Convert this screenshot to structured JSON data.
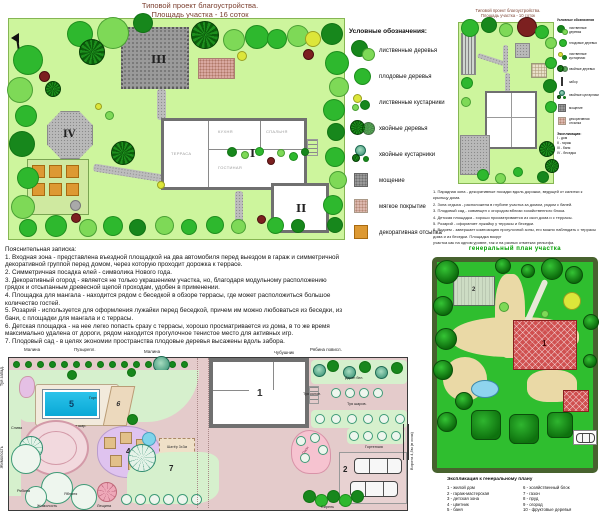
{
  "top_left": {
    "title1": "Типовой проект благоустройства.",
    "title2": "Площадь участка - 16 соток",
    "num_house": "I",
    "num_garage": "II",
    "num_paving": "III",
    "num_gazebo": "IV",
    "room_terrace": "ТЕРРАСА",
    "room_living": "ГОСТИНАЯ",
    "room_kitchen": "КУХНЯ",
    "room_bedroom": "СПАЛЬНЯ"
  },
  "legend": {
    "title": "Условные обозначения:",
    "items": [
      "лиственные деревья",
      "плодовые деревья",
      "лиственные кустарники",
      "хвойные деревья",
      "хвойные кустарники",
      "мощение",
      "мягкое покрытие",
      "декоративная отсыпка"
    ]
  },
  "top_right": {
    "title1": "Типовой проект благоустройства.",
    "title2": "Площадь участка - 10 соток",
    "legend_title": "Условные обозначения",
    "legend_items": [
      "лиственные деревья",
      "плодовые деревья",
      "лиственные кустарники",
      "хвойные деревья",
      "забор",
      "хвойные кустарники",
      "мощение",
      "декоративная отсыпка"
    ],
    "explication_title": "Экспликация:",
    "explication": [
      "I - дом",
      "II - гараж",
      "III - баня",
      "IV - беседка"
    ],
    "notes": [
      "1. Парадная зона - декоративные посадки вдоль дорожки, ведущей от калитки к крыльцу дома.",
      "2. Зона отдыха - расположена в глубине участка за домом, рядом с баней.",
      "3. Плодовый сад - совмещен с огородом вблизи хозяйственного блока.",
      "4. Детская площадка - хорошо просматривается из окон дома и с террасы.",
      "5. Розарий - оформляет лужайку у террасы и беседки."
    ]
  },
  "notes": {
    "title": "Пояснительная записка:",
    "items": [
      "1. Входная зона - представлена въездной площадкой на два автомобиля перед выездом в гараж и симметричной декоративной группой перед домом, через которую проходит дорожка к террасе.",
      "2. Симметричная посадка елей - символика Нового года.",
      "3. Декоративный огород - является не только украшением участка, но, благодаря модульному расположению грядок и отсыпанным древесной щепой проходам, удобен в применении.",
      "4. Площадка для мангала - находится рядом с беседкой в обзоре террасы, где может расположиться большое количество гостей.",
      "5. Розарий - используется для оформления лужайки перед беседкой, причем им можно любоваться из беседки, из бани, с площадки для мангала и с террасы.",
      "6. Детская площадка - на нее легко попасть сразу с террасы, хорошо просматривается из дома, в то же время максимально удалена от дороги, рядом находится прогулочное тенистое место для активных игр.",
      "7. Плодовый сад - в целях экономии пространства плодовые деревья высажены вдоль забора."
    ]
  },
  "bottom_left": {
    "labels": {
      "malina1": "Малина",
      "puzyrepl": "Пузырепл.",
      "malina2": "Малина",
      "chubushnik": "Чубушник",
      "ryabina_povisl": "Рябина повисл.",
      "deren": "Дерен бел.",
      "tuya_kolon": "Туя колон.",
      "tuya_sharov": "Туя шаров.",
      "gort": "Горт.",
      "tuya_shar": "Туя шар.",
      "sliva": "Слива",
      "tuya_zapad": "Туя запад.",
      "zhimolost_left": "Жимолость",
      "ryabina": "Рябина",
      "yablonya": "Яблоня",
      "zhimolost": "Жимолость",
      "leschina": "Лещина",
      "siren": "Сирень",
      "gortenziya": "Гортензия",
      "pion": "Пион",
      "shater": "Шатёр 3х3м",
      "vorota": "Ворота 4,5м (в осях)"
    },
    "nums": {
      "n1": "1",
      "n2": "2",
      "n3": "3",
      "n4": "4",
      "n5": "5",
      "n6": "6",
      "n7": "7"
    }
  },
  "bottom_right": {
    "note_lines": [
      "6. Водоем - завершает композицию прогулочной зоны, его можно наблюдать с террасы дома и из беседки. Площадка вокруг",
      "участка как на одном уровне, так и на разных отметках рельефа."
    ],
    "title": "генеральный план участка",
    "building_main": "1",
    "building_left": "2",
    "explication_title": "Экспликация к генеральному плану",
    "explication_left": [
      "1 - жилой дом",
      "2 - гараж-мастерская",
      "3 - детская зона",
      "4 - цветник",
      "5 - баня"
    ],
    "explication_right": [
      "6 - хозяйственный блок",
      "7 - газон",
      "8 - пруд",
      "9 - огород",
      "10 - фруктовые деревья"
    ]
  }
}
